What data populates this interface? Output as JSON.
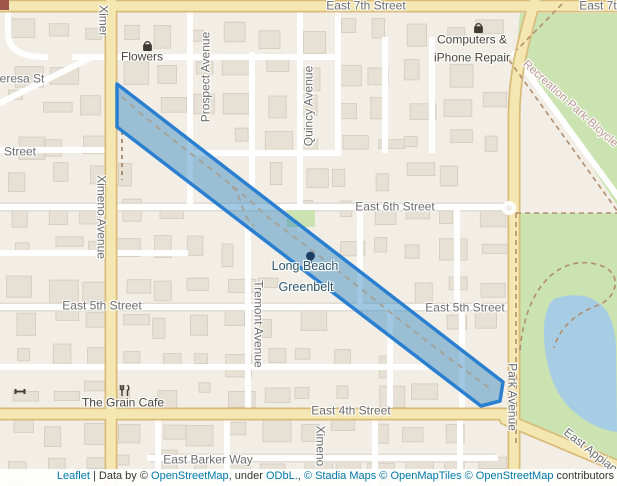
{
  "map": {
    "colors": {
      "bg": "#f2eee5",
      "building": "#e6e0d5",
      "building_stroke": "#d3cbbd",
      "road_fill": "#f5e7b2",
      "road_casing": "#d9bb7a",
      "minor_road": "#ffffff",
      "park": "#cbe3b1",
      "lake": "#a7cde4",
      "belt_fill": "#2e86c0",
      "belt_stroke": "#2a7fd0",
      "trail": "#a3a39b",
      "park_trail": "#b08e6e",
      "label": "#6d6d6d",
      "poi_label": "#49443c",
      "greenbelt_label": "#2f566b",
      "trail_label": "#bd9894",
      "link": "#0078a8"
    },
    "street_labels": [
      {
        "id": "east-7th-left",
        "text": "East 7th Street",
        "x": 366,
        "y": 6
      },
      {
        "id": "east-7th-right",
        "text": "East 7th Street",
        "x": 619,
        "y": 6
      },
      {
        "id": "theresa",
        "text": "Theresa St",
        "x": 15,
        "y": 79
      },
      {
        "id": "street-partial",
        "text": "Street",
        "x": 20,
        "y": 152
      },
      {
        "id": "east-6th",
        "text": "East 6th Street",
        "x": 395,
        "y": 207
      },
      {
        "id": "east-5th-left",
        "text": "East 5th Street",
        "x": 102,
        "y": 306
      },
      {
        "id": "east-5th-right",
        "text": "East 5th Street",
        "x": 465,
        "y": 308
      },
      {
        "id": "east-4th",
        "text": "East 4th Street",
        "x": 351,
        "y": 411
      },
      {
        "id": "east-barker",
        "text": "East Barker Way",
        "x": 208,
        "y": 460
      },
      {
        "id": "prospect",
        "text": "Prospect Avenue",
        "x": 206,
        "y": 77,
        "rot": -90
      },
      {
        "id": "quincy",
        "text": "Quincy Avenue",
        "x": 309,
        "y": 106,
        "rot": -90
      },
      {
        "id": "ximeno-top",
        "text": "Ximeno Avenue",
        "x": 12,
        "y": 47,
        "rot": 90,
        "clip": [
          91,
          0,
          24,
          36
        ]
      },
      {
        "id": "ximeno-mid",
        "text": "Ximeno Avenue",
        "x": 101,
        "y": 217,
        "rot": 90
      },
      {
        "id": "tremont",
        "text": "Tremont Avenue",
        "x": 258,
        "y": 324,
        "rot": 90
      },
      {
        "id": "ximeno-bottom",
        "text": "Ximeno",
        "x": 320,
        "y": 446,
        "rot": 90
      },
      {
        "id": "park-avenue",
        "text": "Park Avenue",
        "x": 512,
        "y": 397,
        "rot": 90
      },
      {
        "id": "east-appian",
        "text": "East Appian Way",
        "x": 601,
        "y": 459,
        "rot": 38
      },
      {
        "id": "recreation-trail",
        "text": "Recreation-Park-Bicycle",
        "x": 570,
        "y": 104,
        "rot": 42,
        "color_key": "trail_label",
        "size": 11.5
      }
    ],
    "pois": [
      {
        "id": "flowers",
        "icon": "bag",
        "ix": 141,
        "iy": 40,
        "lines": [
          {
            "text": "Flowers",
            "x": 142,
            "y": 57
          }
        ]
      },
      {
        "id": "computers-iphone-repair",
        "icon": "bag",
        "ix": 472,
        "iy": 22,
        "lines": [
          {
            "text": "Computers &",
            "x": 472,
            "y": 40
          },
          {
            "text": "iPhone Repair",
            "x": 472,
            "y": 58
          }
        ]
      },
      {
        "id": "grain-cafe",
        "icon": "restaurant",
        "ix": 118,
        "iy": 384,
        "lines": [
          {
            "text": "The Grain Cafe",
            "x": 123,
            "y": 403
          }
        ]
      },
      {
        "id": "fitness",
        "icon": "fitness",
        "ix": 14,
        "iy": 385,
        "lines": []
      },
      {
        "id": "long-beach-greenbelt",
        "icon": "tree",
        "ix": 303,
        "iy": 251,
        "color_key": "greenbelt_label",
        "size": 12.5,
        "lines": [
          {
            "text": "Long Beach",
            "x": 305,
            "y": 267
          },
          {
            "text": "Greenbelt",
            "x": 306,
            "y": 288
          }
        ]
      }
    ]
  },
  "attribution": {
    "parts": [
      {
        "text": "Leaflet",
        "link": true
      },
      {
        "text": " | Data by © "
      },
      {
        "text": "OpenStreetMap",
        "link": true
      },
      {
        "text": ", under "
      },
      {
        "text": "ODbL.",
        "link": true
      },
      {
        "text": ", "
      },
      {
        "text": "© Stadia Maps",
        "link": true
      },
      {
        "text": " "
      },
      {
        "text": "© OpenMapTiles",
        "link": true
      },
      {
        "text": " "
      },
      {
        "text": "© OpenStreetMap",
        "link": true
      },
      {
        "text": " contributors"
      }
    ]
  }
}
